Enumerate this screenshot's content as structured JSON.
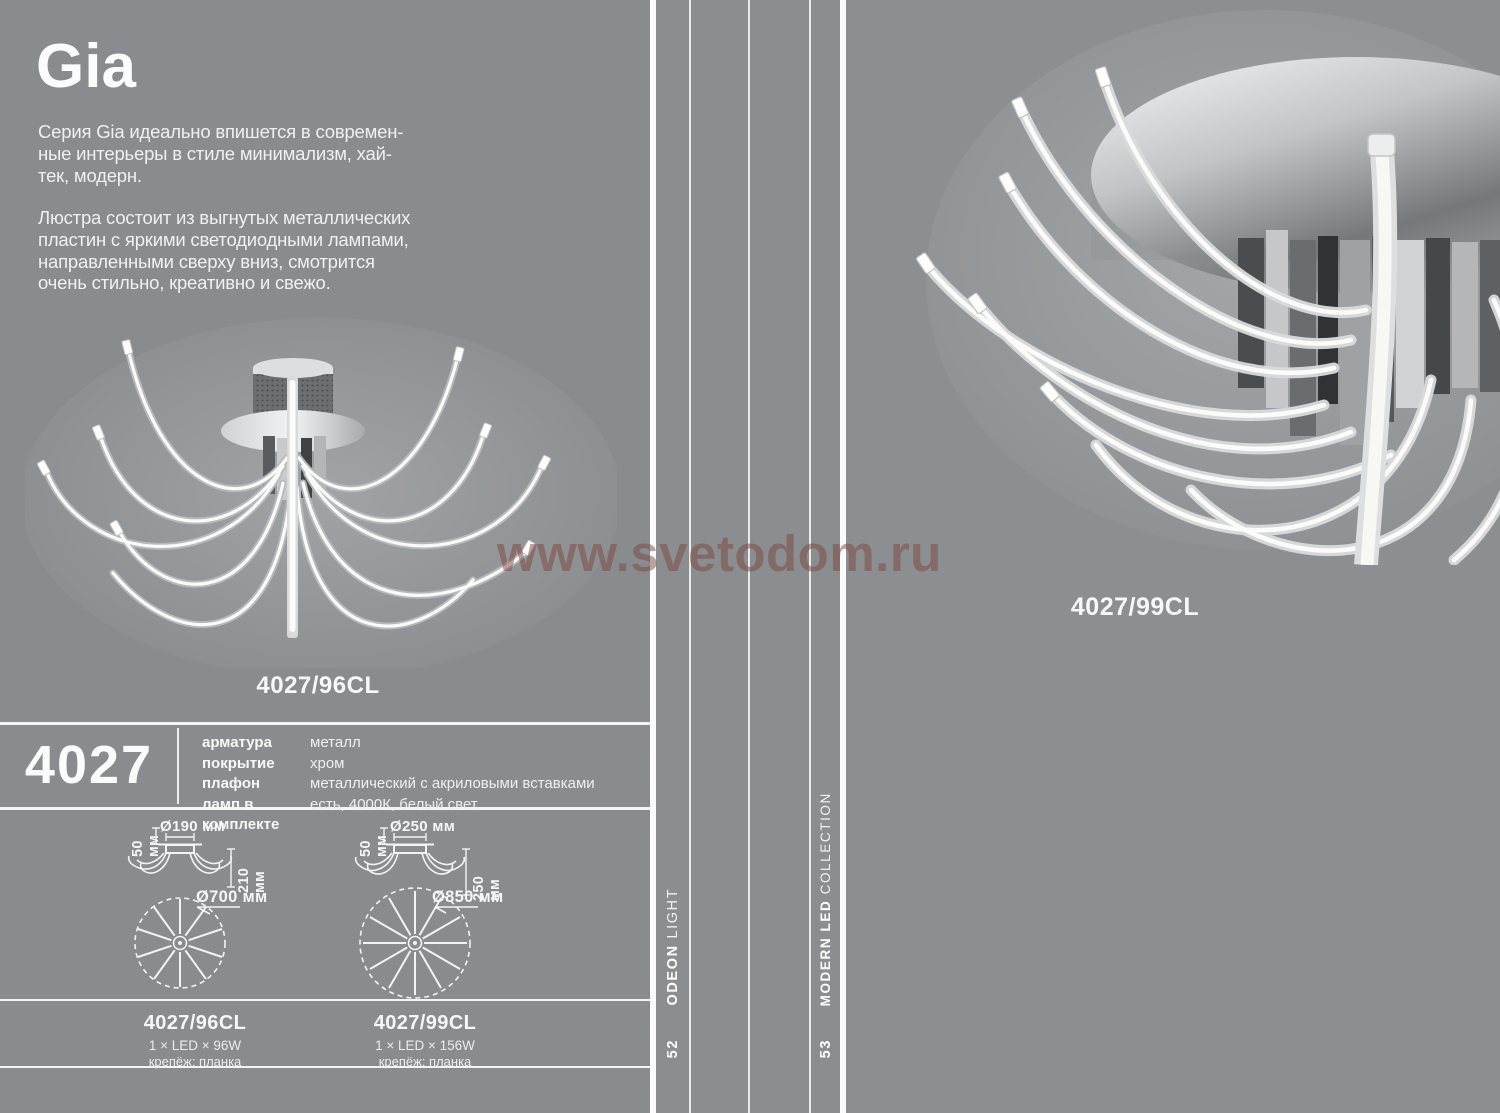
{
  "colors": {
    "page_bg": "#8b8e90",
    "left_page_bg": "#898c8e",
    "rule_white": "#f5f6f6",
    "text_white": "#f2f4f4",
    "watermark_red": "#7e463e",
    "chrome_light": "#e8eaeb",
    "chrome_dark": "#54575a"
  },
  "left_page": {
    "title": "Gia",
    "intro_lines": [
      "Серия Gia идеально впишется в современ-",
      "ные интерьеры в стиле минимализм, хай-",
      "тек, модерн."
    ],
    "description_lines": [
      "Люстра состоит из выгнутых металлических",
      "пластин с яркими светодиодными лампами,",
      "направленными сверху вниз, смотрится",
      "очень стильно, креативно и свежо."
    ],
    "product_label": "4027/96CL",
    "series_number": "4027",
    "specs": [
      {
        "label": "арматура",
        "value": "металл"
      },
      {
        "label": "покрытие",
        "value": "хром"
      },
      {
        "label": "плафон",
        "value": "металлический с акриловыми вставками"
      },
      {
        "label": "ламп в комплекте",
        "value": "есть, 4000К, белый свет"
      }
    ],
    "diagrams": [
      {
        "canopy_height": "50 мм",
        "canopy_diameter": "Ø190 мм",
        "fixture_height": "210 мм",
        "fixture_diameter": "Ø700 мм"
      },
      {
        "canopy_height": "50 мм",
        "canopy_diameter": "Ø250 мм",
        "fixture_height": "250 мм",
        "fixture_diameter": "Ø850 мм"
      }
    ],
    "models": [
      {
        "code": "4027/96CL",
        "lamps": "1 × LED × 96W",
        "mount": "крепёж: планка"
      },
      {
        "code": "4027/99CL",
        "lamps": "1 × LED × 156W",
        "mount": "крепёж: планка"
      }
    ]
  },
  "right_page": {
    "product_label": "4027/99CL"
  },
  "sidebars": {
    "brand": {
      "bold": "ODEON ",
      "light": "LIGHT",
      "page_number": "52"
    },
    "collection": {
      "bold": "MODERN LED ",
      "light": "COLLECTION",
      "page_number": "53"
    }
  },
  "watermark": "www.svetodom.ru"
}
